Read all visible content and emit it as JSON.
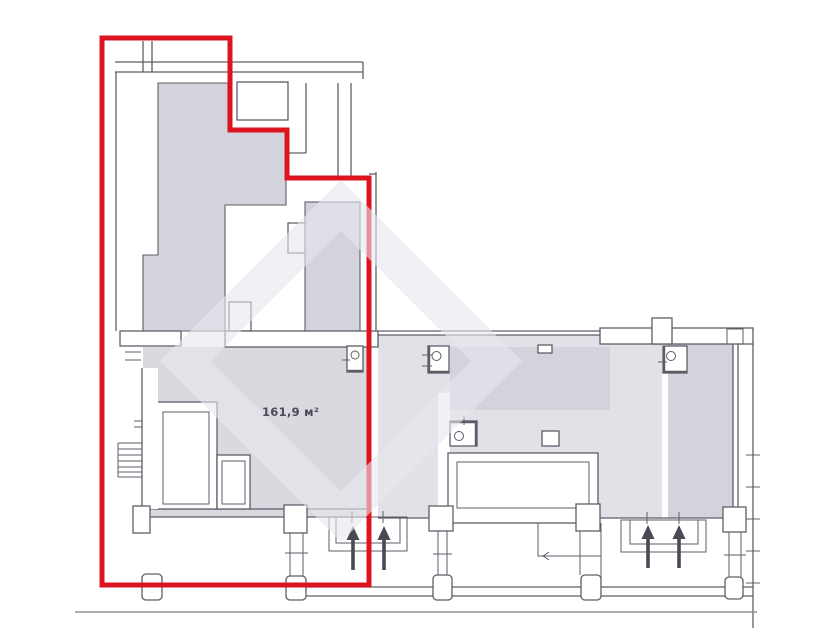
{
  "plan": {
    "area_label": "161,9 м²",
    "area_value": "161,9",
    "area_unit": "м²",
    "entrance_arrow_count": 4
  },
  "icons": {
    "entrance_arrow": "up-arrow",
    "stairs": "stair-rungs",
    "door_fixture": "box-with-circle",
    "watermark": "rotated-square-house-logo"
  },
  "colors": {
    "page_bg": "#ffffff",
    "boundary_red": "#dc1420",
    "wall_line": "#5d5d68",
    "room_gray_dark": "#d3d3db",
    "room_gray": "#d9d9e0",
    "room_gray_light": "#e1e1e8",
    "arrow_dark": "#4a4a55",
    "ground_line": "#90909b",
    "watermark_gray": "rgba(232,232,238,0.6)",
    "label_text": "#4a4a54"
  }
}
